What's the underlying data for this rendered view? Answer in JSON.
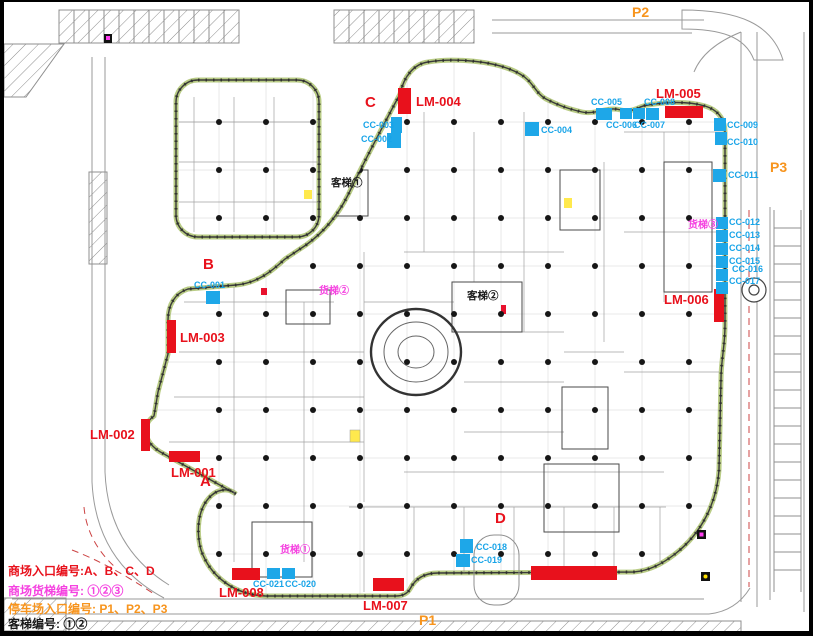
{
  "legend": {
    "lines": [
      {
        "id": "mall-entrances",
        "text": "商场入口编号:A、B、C、D",
        "color": "#e8111c",
        "y": 563
      },
      {
        "id": "freight-elevators",
        "text": "商场货梯编号: ①②③",
        "color": "#f542e0",
        "y": 583
      },
      {
        "id": "parking-entrances",
        "text": "停车场入口编号: P1、P2、P3",
        "color": "#f7941d",
        "y": 601
      },
      {
        "id": "passenger-elevators",
        "text": "客梯编号: ①②",
        "color": "#1a1a1a",
        "y": 616
      }
    ]
  },
  "colors": {
    "entrance_red": "#e8111c",
    "escalator_blue": "#1ea7e8",
    "parking_orange": "#f7941d",
    "freight_magenta": "#f542e0",
    "elevator_black": "#1a1a1a",
    "perimeter_green": "#b9cc85"
  },
  "markers": {
    "mall_entrances": [
      {
        "id": "LM-001",
        "bar": {
          "x": 165,
          "y": 449,
          "w": 31,
          "h": 11
        },
        "label_pos": {
          "x": 167,
          "y": 464
        }
      },
      {
        "id": "LM-002",
        "bar": {
          "x": 137,
          "y": 417,
          "w": 9,
          "h": 32
        },
        "label_pos": {
          "x": 86,
          "y": 426
        }
      },
      {
        "id": "LM-003",
        "bar": {
          "x": 163,
          "y": 318,
          "w": 9,
          "h": 33
        },
        "label_pos": {
          "x": 176,
          "y": 329
        }
      },
      {
        "id": "LM-004",
        "bar": {
          "x": 394,
          "y": 86,
          "w": 13,
          "h": 26
        },
        "label_pos": {
          "x": 412,
          "y": 93
        }
      },
      {
        "id": "LM-005",
        "bar": {
          "x": 661,
          "y": 104,
          "w": 38,
          "h": 12
        },
        "label_pos": {
          "x": 652,
          "y": 85
        }
      },
      {
        "id": "LM-006",
        "bar": {
          "x": 710,
          "y": 287,
          "w": 10,
          "h": 33
        },
        "label_pos": {
          "x": 660,
          "y": 291
        }
      },
      {
        "id": "LM-007",
        "bar": {
          "x": 369,
          "y": 576,
          "w": 31,
          "h": 13
        },
        "label_pos": {
          "x": 359,
          "y": 597
        }
      },
      {
        "id": "LM-008",
        "bar": {
          "x": 228,
          "y": 566,
          "w": 28,
          "h": 12
        },
        "label_pos": {
          "x": 215,
          "y": 584
        }
      }
    ],
    "extra_entrance_bars": [
      {
        "x": 527,
        "y": 564,
        "w": 86,
        "h": 14
      }
    ],
    "escalators": [
      {
        "id": "CC-001",
        "rect": {
          "x": 202,
          "y": 289,
          "w": 14,
          "h": 13
        },
        "label_pos": {
          "x": 190,
          "y": 279
        }
      },
      {
        "id": "CC-002",
        "rect": {
          "x": 383,
          "y": 131,
          "w": 14,
          "h": 15
        },
        "label_pos": {
          "x": 357,
          "y": 133
        }
      },
      {
        "id": "CC-003",
        "rect": {
          "x": 387,
          "y": 115,
          "w": 11,
          "h": 16
        },
        "label_pos": {
          "x": 359,
          "y": 119
        }
      },
      {
        "id": "CC-004",
        "rect": {
          "x": 521,
          "y": 120,
          "w": 14,
          "h": 14
        },
        "label_pos": {
          "x": 537,
          "y": 124
        }
      },
      {
        "id": "CC-005",
        "rect": {
          "x": 592,
          "y": 106,
          "w": 16,
          "h": 12
        },
        "label_pos": {
          "x": 587,
          "y": 96
        }
      },
      {
        "id": "CC-006",
        "rect": {
          "x": 616,
          "y": 106,
          "w": 12,
          "h": 11
        },
        "label_pos": {
          "x": 602,
          "y": 119
        }
      },
      {
        "id": "CC-007",
        "rect": {
          "x": 629,
          "y": 106,
          "w": 12,
          "h": 11
        },
        "label_pos": {
          "x": 630,
          "y": 119
        }
      },
      {
        "id": "CC-008",
        "rect": {
          "x": 642,
          "y": 106,
          "w": 13,
          "h": 12
        },
        "label_pos": {
          "x": 640,
          "y": 96
        }
      },
      {
        "id": "CC-009",
        "rect": {
          "x": 710,
          "y": 116,
          "w": 12,
          "h": 13
        },
        "label_pos": {
          "x": 723,
          "y": 119
        }
      },
      {
        "id": "CC-010",
        "rect": {
          "x": 711,
          "y": 130,
          "w": 12,
          "h": 13
        },
        "label_pos": {
          "x": 723,
          "y": 136
        }
      },
      {
        "id": "CC-011",
        "rect": {
          "x": 709,
          "y": 167,
          "w": 13,
          "h": 13
        },
        "label_pos": {
          "x": 724,
          "y": 169
        }
      },
      {
        "id": "CC-012",
        "rect": {
          "x": 712,
          "y": 215,
          "w": 12,
          "h": 12
        },
        "label_pos": {
          "x": 725,
          "y": 216
        }
      },
      {
        "id": "CC-013",
        "rect": {
          "x": 712,
          "y": 228,
          "w": 12,
          "h": 12
        },
        "label_pos": {
          "x": 725,
          "y": 229
        }
      },
      {
        "id": "CC-014",
        "rect": {
          "x": 712,
          "y": 241,
          "w": 12,
          "h": 12
        },
        "label_pos": {
          "x": 725,
          "y": 242
        }
      },
      {
        "id": "CC-015",
        "rect": {
          "x": 712,
          "y": 254,
          "w": 12,
          "h": 12
        },
        "label_pos": {
          "x": 725,
          "y": 255
        }
      },
      {
        "id": "CC-016",
        "rect": {
          "x": 712,
          "y": 267,
          "w": 12,
          "h": 12
        },
        "label_pos": {
          "x": 728,
          "y": 263
        }
      },
      {
        "id": "CC-017",
        "rect": {
          "x": 712,
          "y": 280,
          "w": 12,
          "h": 12
        },
        "label_pos": {
          "x": 725,
          "y": 275
        }
      },
      {
        "id": "CC-018",
        "rect": {
          "x": 456,
          "y": 537,
          "w": 13,
          "h": 14
        },
        "label_pos": {
          "x": 472,
          "y": 541
        }
      },
      {
        "id": "CC-019",
        "rect": {
          "x": 452,
          "y": 552,
          "w": 14,
          "h": 13
        },
        "label_pos": {
          "x": 467,
          "y": 554
        }
      },
      {
        "id": "CC-020",
        "rect": {
          "x": 278,
          "y": 566,
          "w": 13,
          "h": 11
        },
        "label_pos": {
          "x": 281,
          "y": 578
        }
      },
      {
        "id": "CC-021",
        "rect": {
          "x": 263,
          "y": 566,
          "w": 13,
          "h": 11
        },
        "label_pos": {
          "x": 249,
          "y": 578
        }
      }
    ],
    "entrance_letters": [
      {
        "id": "A",
        "x": 196,
        "y": 472
      },
      {
        "id": "B",
        "x": 199,
        "y": 255
      },
      {
        "id": "C",
        "x": 361,
        "y": 93
      },
      {
        "id": "D",
        "x": 491,
        "y": 509
      }
    ],
    "parking": [
      {
        "id": "P1",
        "x": 415,
        "y": 611
      },
      {
        "id": "P2",
        "x": 628,
        "y": 3
      },
      {
        "id": "P3",
        "x": 766,
        "y": 158
      }
    ],
    "freight_elevators": [
      {
        "label": "货梯①",
        "x": 276,
        "y": 544
      },
      {
        "label": "货梯②",
        "x": 315,
        "y": 285
      },
      {
        "label": "货梯③",
        "x": 684,
        "y": 219
      }
    ],
    "passenger_elevators": [
      {
        "label": "客梯①",
        "x": 327,
        "y": 176
      },
      {
        "label": "客梯②",
        "x": 463,
        "y": 289
      }
    ]
  },
  "plan_grid": {
    "xs": [
      215,
      262,
      309,
      356,
      403,
      450,
      497,
      544,
      591,
      638,
      685
    ],
    "ys": [
      120,
      168,
      216,
      264,
      312,
      360,
      408,
      456,
      504,
      552
    ]
  }
}
